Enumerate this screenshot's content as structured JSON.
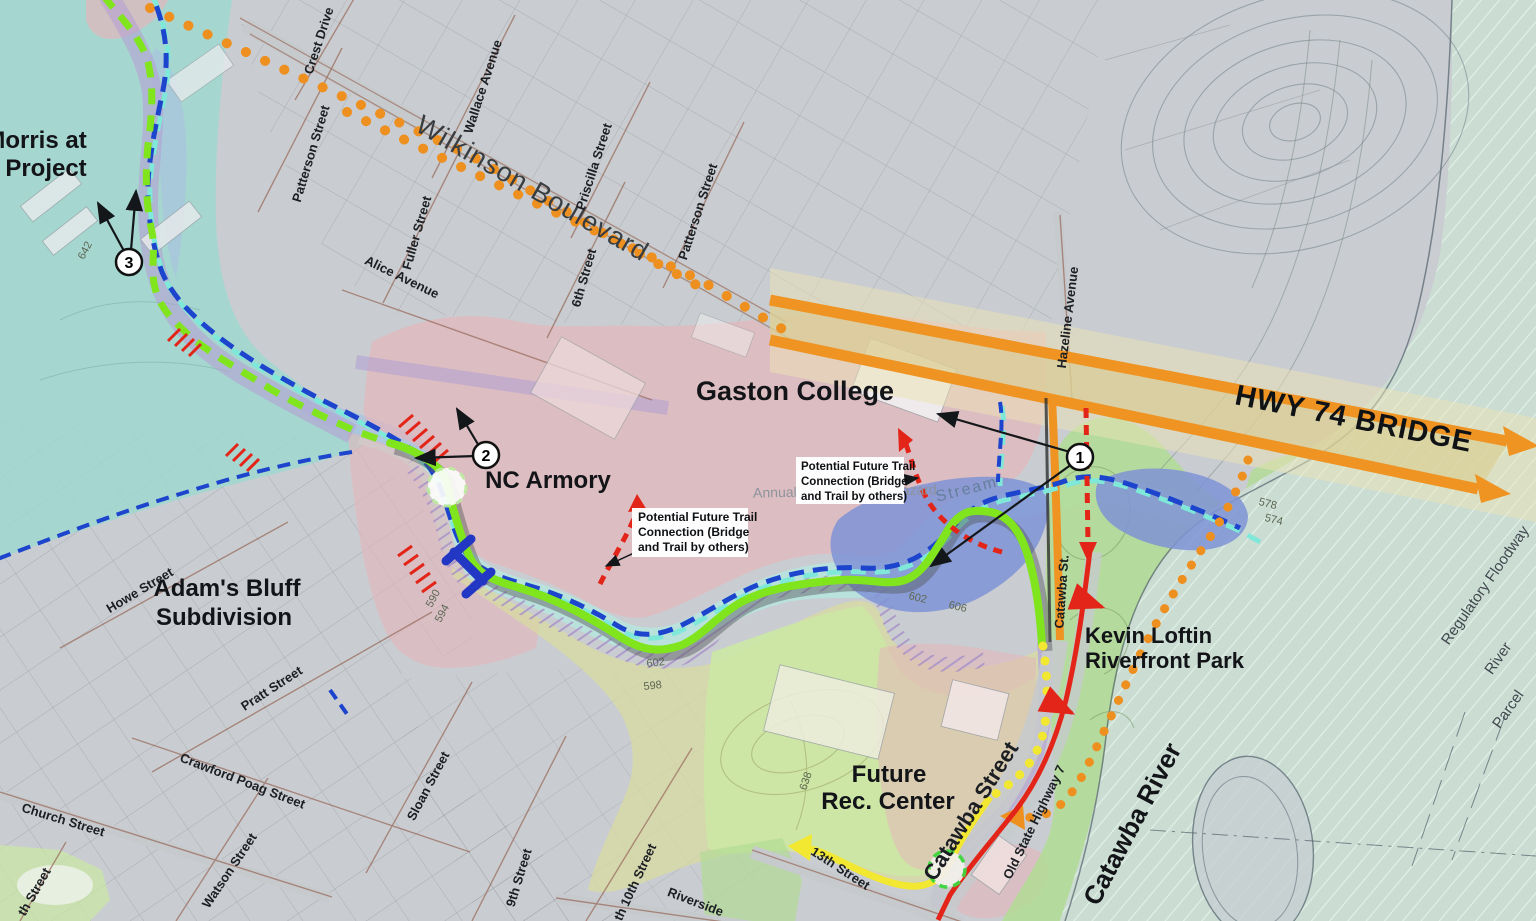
{
  "colors": {
    "base": "#c9cdd1",
    "grid": "#8d9298",
    "teal": "#9ed8cf",
    "stream_band": "#b7e5de",
    "light_blue": "#a9c0e2",
    "pink": "#e4b6ba",
    "purple": "#b4a0d2",
    "purple_hatch": "#a78fc8",
    "olive": "#d8d9a0",
    "rec_green": "#cce8a4",
    "park_green": "#b2dc94",
    "pond_blue": "#7f93d6",
    "river": "#cbdcd3",
    "river_hatch": "#e2f3e9",
    "island": "#c6ced3",
    "road_maroon": "#9b6f60",
    "road_gray": "#c6cacd",
    "hwy_orange": "#ef9322",
    "hwy_tan": "#d9c98c",
    "hwy_halo": "#ece4b6",
    "dot_orange": "#ee9020",
    "trail_green": "#80e51c",
    "trail_shadow": "#54575a",
    "trail_yellow": "#f2e832",
    "red": "#e32418",
    "stream_blue": "#1c44cc",
    "stream_cyan": "#7fe8d8",
    "bridge_blue": "#2237c4",
    "ink": "#14171a",
    "white": "#ffffff"
  },
  "map": {
    "regions": {
      "morris_line1": "Morris at",
      "morris_line2": "Project",
      "gaston_college": "Gaston College",
      "nc_armory": "NC Armory",
      "adams_bluff_line1": "Adam's Bluff",
      "adams_bluff_line2": "Subdivision",
      "future_rec_line1": "Future",
      "future_rec_line2": "Rec. Center",
      "kevin_loftin_line1": "Kevin Loftin",
      "kevin_loftin_line2": "Riverfront Park",
      "catawba_river": "Catawba River",
      "hwy_74_bridge": "HWY 74 BRIDGE"
    },
    "streets": {
      "crest_drive": "Crest Drive",
      "wallace_avenue": "Wallace Avenue",
      "patterson_street": "Patterson Street",
      "wilkinson_boulevard": "Wilkinson Boulevard",
      "priscilla_street": "Priscilla Street",
      "fuller_street": "Fuller Street",
      "sixth_street": "6th Street",
      "alice_avenue": "Alice Avenue",
      "hazeline_avenue": "Hazeline Avenue",
      "howe_street": "Howe Street",
      "pratt_street": "Pratt Street",
      "crawford_poag_street": "Crawford Poag Street",
      "church_street": "Church Street",
      "watson_street": "Watson Street",
      "partial_th_street": "th Street",
      "sloan_street": "Sloan Street",
      "ninth_street": "9th Street",
      "south_tenth_street": "th 10th Street",
      "riverside": "Riverside",
      "thirteenth_street": "13th Street",
      "catawba_street": "Catawba Street",
      "catawba_st_short": "Catawba St.",
      "old_state_highway_7": "Old State Highway 7"
    },
    "water": {
      "stream": "Stream",
      "regulatory_floodway": "Regulatory Floodway",
      "river": "River",
      "parcel": "Parcel",
      "flood_hazard_text": "Annual Chance Flood Hazard"
    },
    "contours": {
      "e642": "642",
      "e590": "590",
      "e594": "594",
      "e602": "602",
      "e598": "598",
      "e606": "606",
      "e638": "638",
      "e578": "578",
      "e574": "574"
    },
    "markers": {
      "one": "1",
      "two": "2",
      "three": "3"
    },
    "note_box": {
      "line1": "Potential Future Trail",
      "line2": "Connection (Bridge",
      "line3": "and Trail by others)"
    }
  }
}
